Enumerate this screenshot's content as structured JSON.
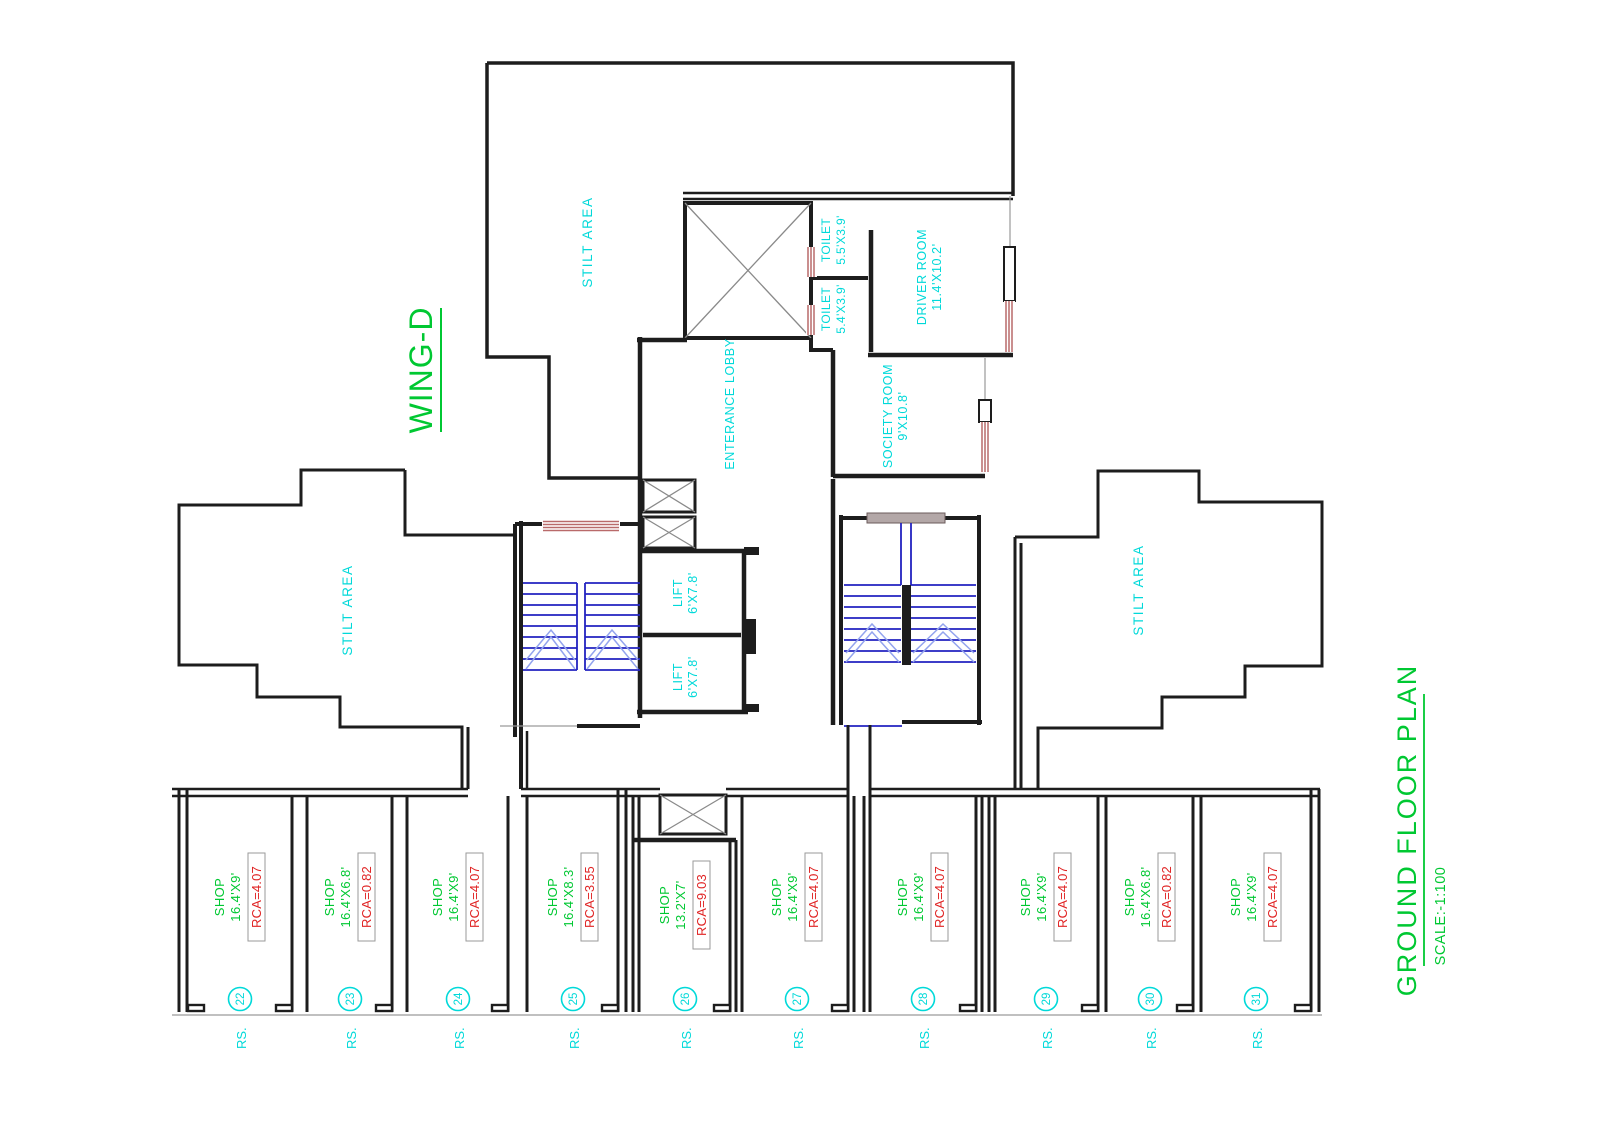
{
  "drawing": {
    "wing_label": "WING-D",
    "title": "GROUND FLOOR PLAN",
    "scale": "SCALE:-1:100"
  },
  "areas": {
    "stilt_top": "STILT AREA",
    "stilt_left": "STILT AREA",
    "stilt_right": "STILT AREA",
    "entrance_lobby": "ENTERANCE LOBBY",
    "society_room": {
      "name": "SOCIETY ROOM",
      "size": "9'X10.8'"
    },
    "driver_room": {
      "name": "DRIVER ROOM",
      "size": "11.4'X10.2'"
    },
    "toilet_upper": {
      "name": "TOILET",
      "size": "5.5'X3.9'"
    },
    "toilet_lower": {
      "name": "TOILET",
      "size": "5.4'X3.9'"
    },
    "lift_upper": {
      "name": "LIFT",
      "size": "6'X7.8'"
    },
    "lift_lower": {
      "name": "LIFT",
      "size": "6'X7.8'"
    }
  },
  "shops": [
    {
      "prefix": "RS.",
      "number": "22",
      "name": "SHOP",
      "size": "16.4'X9'",
      "rca": "RCA=4.07"
    },
    {
      "prefix": "RS.",
      "number": "23",
      "name": "SHOP",
      "size": "16.4'X6.8'",
      "rca": "RCA=0.82"
    },
    {
      "prefix": "RS.",
      "number": "24",
      "name": "SHOP",
      "size": "16.4'X9'",
      "rca": "RCA=4.07"
    },
    {
      "prefix": "RS.",
      "number": "25",
      "name": "SHOP",
      "size": "16.4'X8.3'",
      "rca": "RCA=3.55"
    },
    {
      "prefix": "RS.",
      "number": "26",
      "name": "SHOP",
      "size": "13.2'X7'",
      "rca": "RCA=9.03"
    },
    {
      "prefix": "RS.",
      "number": "27",
      "name": "SHOP",
      "size": "16.4'X9'",
      "rca": "RCA=4.07"
    },
    {
      "prefix": "RS.",
      "number": "28",
      "name": "SHOP",
      "size": "16.4'X9'",
      "rca": "RCA=4.07"
    },
    {
      "prefix": "RS.",
      "number": "29",
      "name": "SHOP",
      "size": "16.4'X9'",
      "rca": "RCA=4.07"
    },
    {
      "prefix": "RS.",
      "number": "30",
      "name": "SHOP",
      "size": "16.4'X6.8'",
      "rca": "RCA=0.82"
    },
    {
      "prefix": "RS.",
      "number": "31",
      "name": "SHOP",
      "size": "16.4'X9'",
      "rca": "RCA=4.07"
    }
  ],
  "colors": {
    "accent_green": "#00c832",
    "label_cyan": "#00d9d9",
    "rca_red": "#e02424",
    "wall_black": "#1d1d1d",
    "stair_blue": "#2323c0",
    "arrow_blue": "#93a4ee",
    "door_brown": "#b96a6a",
    "landing_gray": "#b3a7a7",
    "thin_gray": "#9a9a9a"
  }
}
